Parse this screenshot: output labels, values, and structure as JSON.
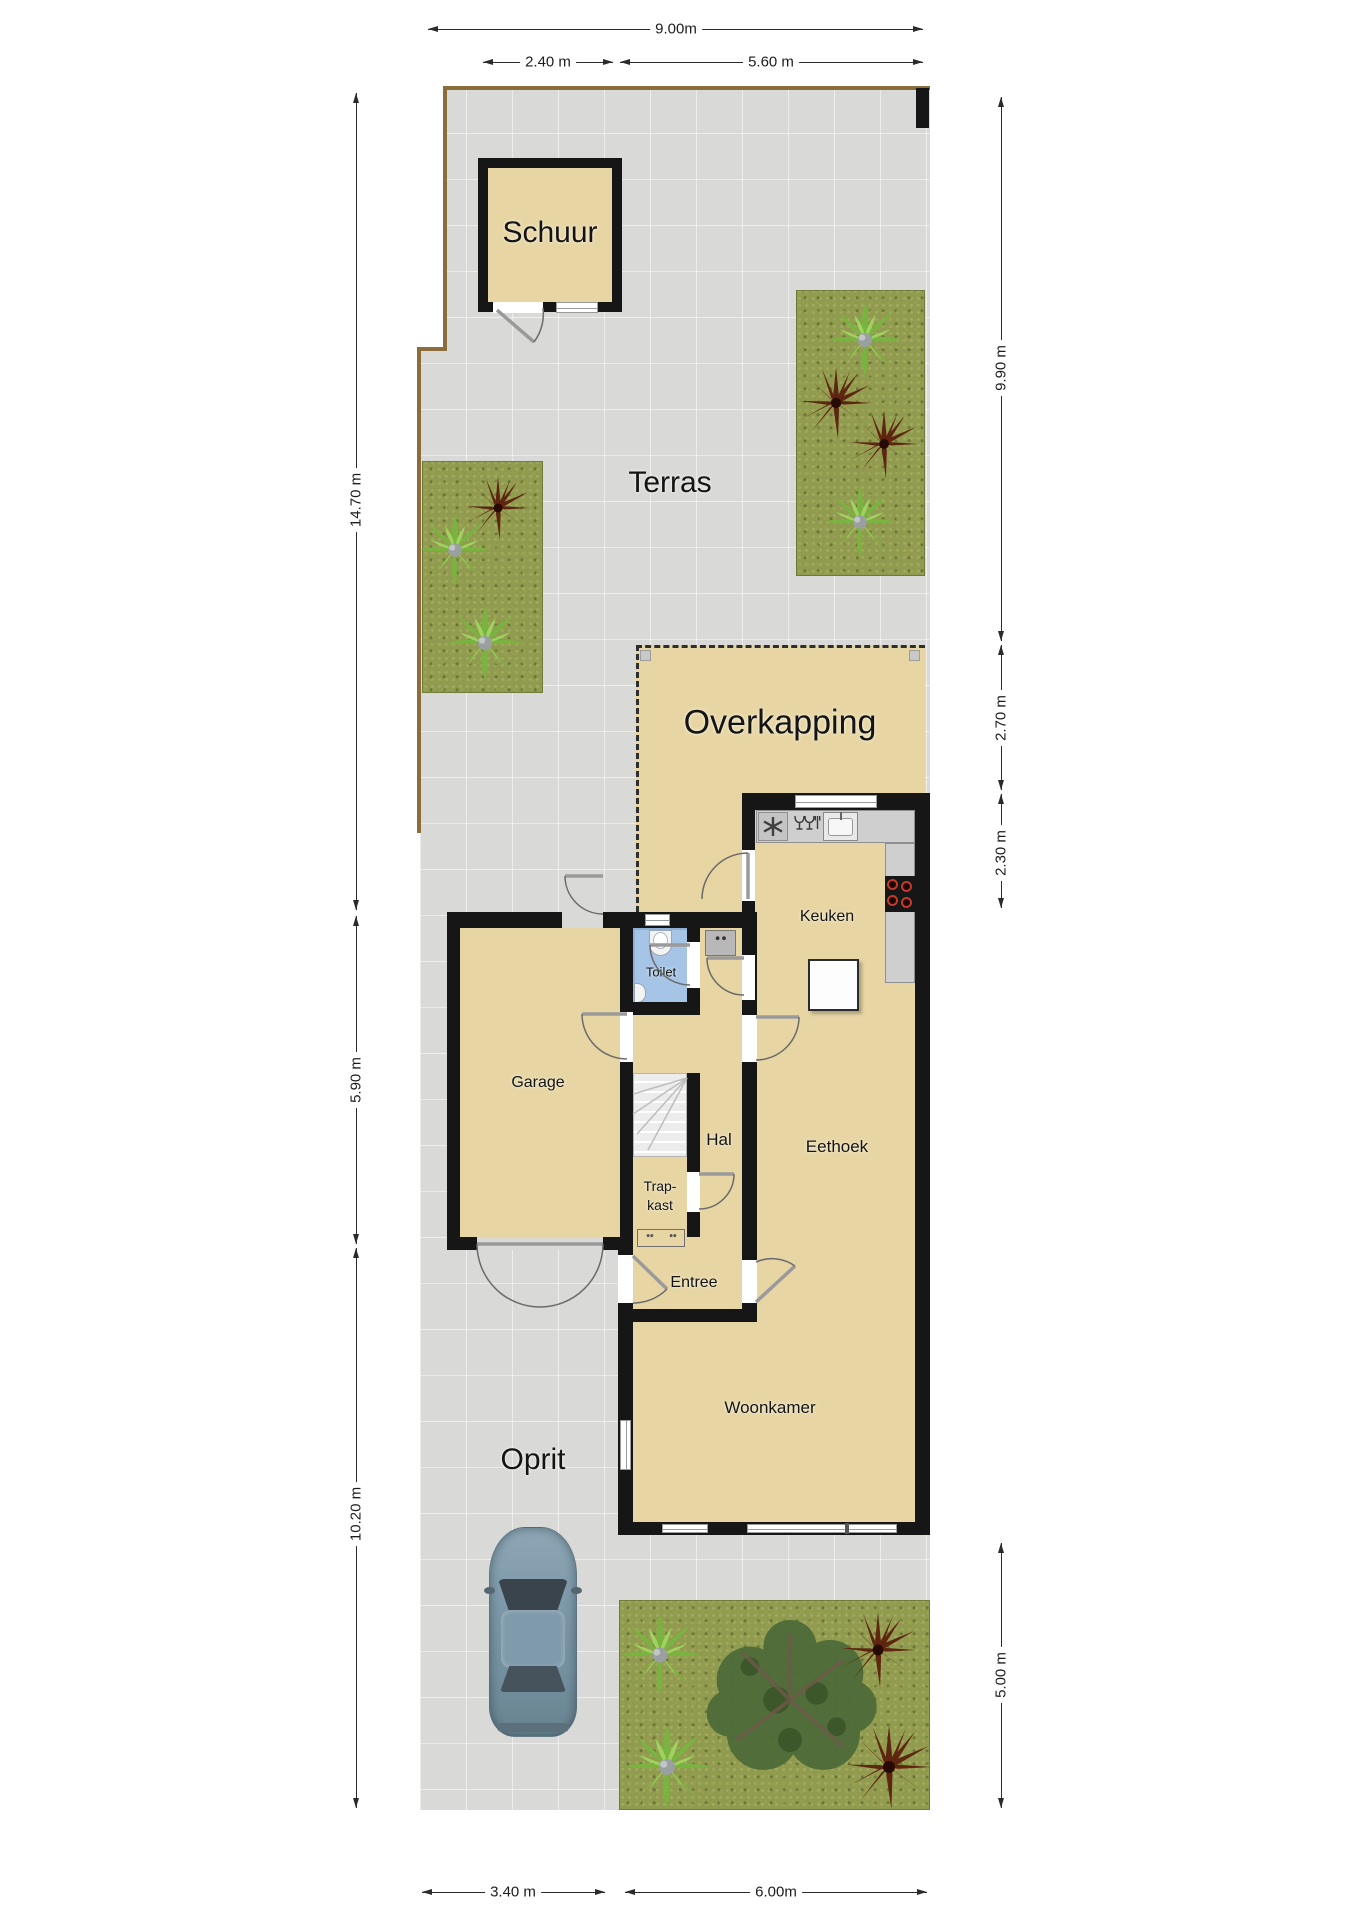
{
  "labels": {
    "schuur": "Schuur",
    "terras": "Terras",
    "overkapping": "Overkapping",
    "keuken": "Keuken",
    "toilet": "Toilet",
    "garage": "Garage",
    "hal": "Hal",
    "trapkast_line1": "Trap-",
    "trapkast_line2": "kast",
    "eethoek": "Eethoek",
    "entree": "Entree",
    "woonkamer": "Woonkamer",
    "oprit": "Oprit"
  },
  "dimensions": {
    "top_total": "9.00m",
    "top_schuur": "2.40 m",
    "top_right": "5.60 m",
    "left_upper": "14.70 m",
    "left_garage": "5.90 m",
    "left_lower": "10.20 m",
    "right_terras": "9.90 m",
    "right_overkapping": "2.70 m",
    "right_keuken": "2.30 m",
    "right_tuin": "5.00 m",
    "bottom_oprit": "3.40 m",
    "bottom_tuin": "6.00m"
  },
  "colors": {
    "wall": "#161616",
    "room_fill": "#e7d6a4",
    "paving": "#d9d9d7",
    "toilet_floor": "#a6c4e5",
    "grass": "#919b4f",
    "hob_burner": "#c5392a",
    "boundary_fence": "#8a6d3b"
  }
}
